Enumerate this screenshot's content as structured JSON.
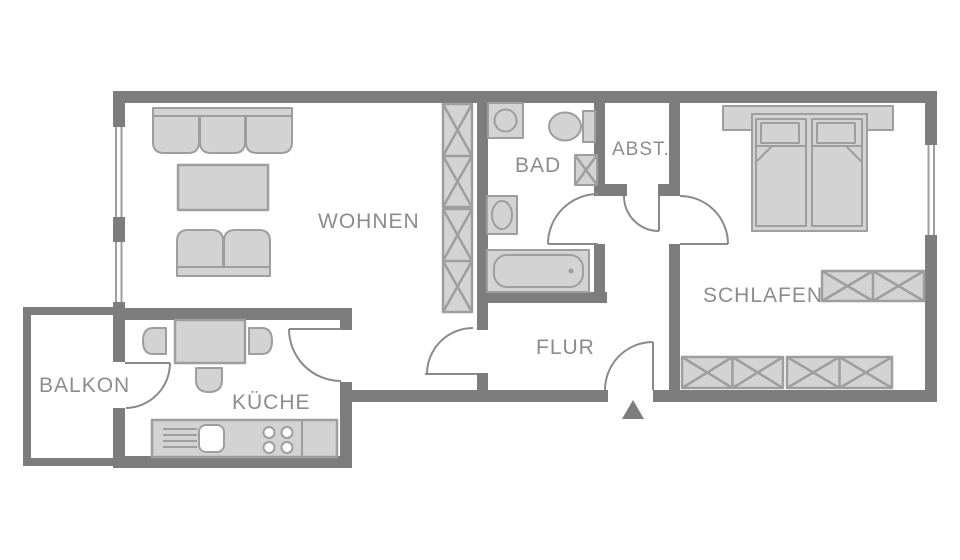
{
  "plan": {
    "type": "apartment-floorplan",
    "rooms": [
      {
        "id": "wohnen",
        "label": "WOHNEN"
      },
      {
        "id": "bad",
        "label": "BAD"
      },
      {
        "id": "abst",
        "label": "ABST."
      },
      {
        "id": "schlafen",
        "label": "SCHLAFEN"
      },
      {
        "id": "flur",
        "label": "FLUR"
      },
      {
        "id": "balkon",
        "label": "BALKON"
      },
      {
        "id": "kueche",
        "label": "KÜCHE"
      }
    ],
    "colors": {
      "wall": "#7d7d7d",
      "furniture_fill": "#d3d3d3",
      "furniture_stroke": "#9e9e9e",
      "label_text": "#8c8c8c",
      "background": "#ffffff"
    },
    "markers": {
      "entrance": "triangle-arrow"
    }
  }
}
